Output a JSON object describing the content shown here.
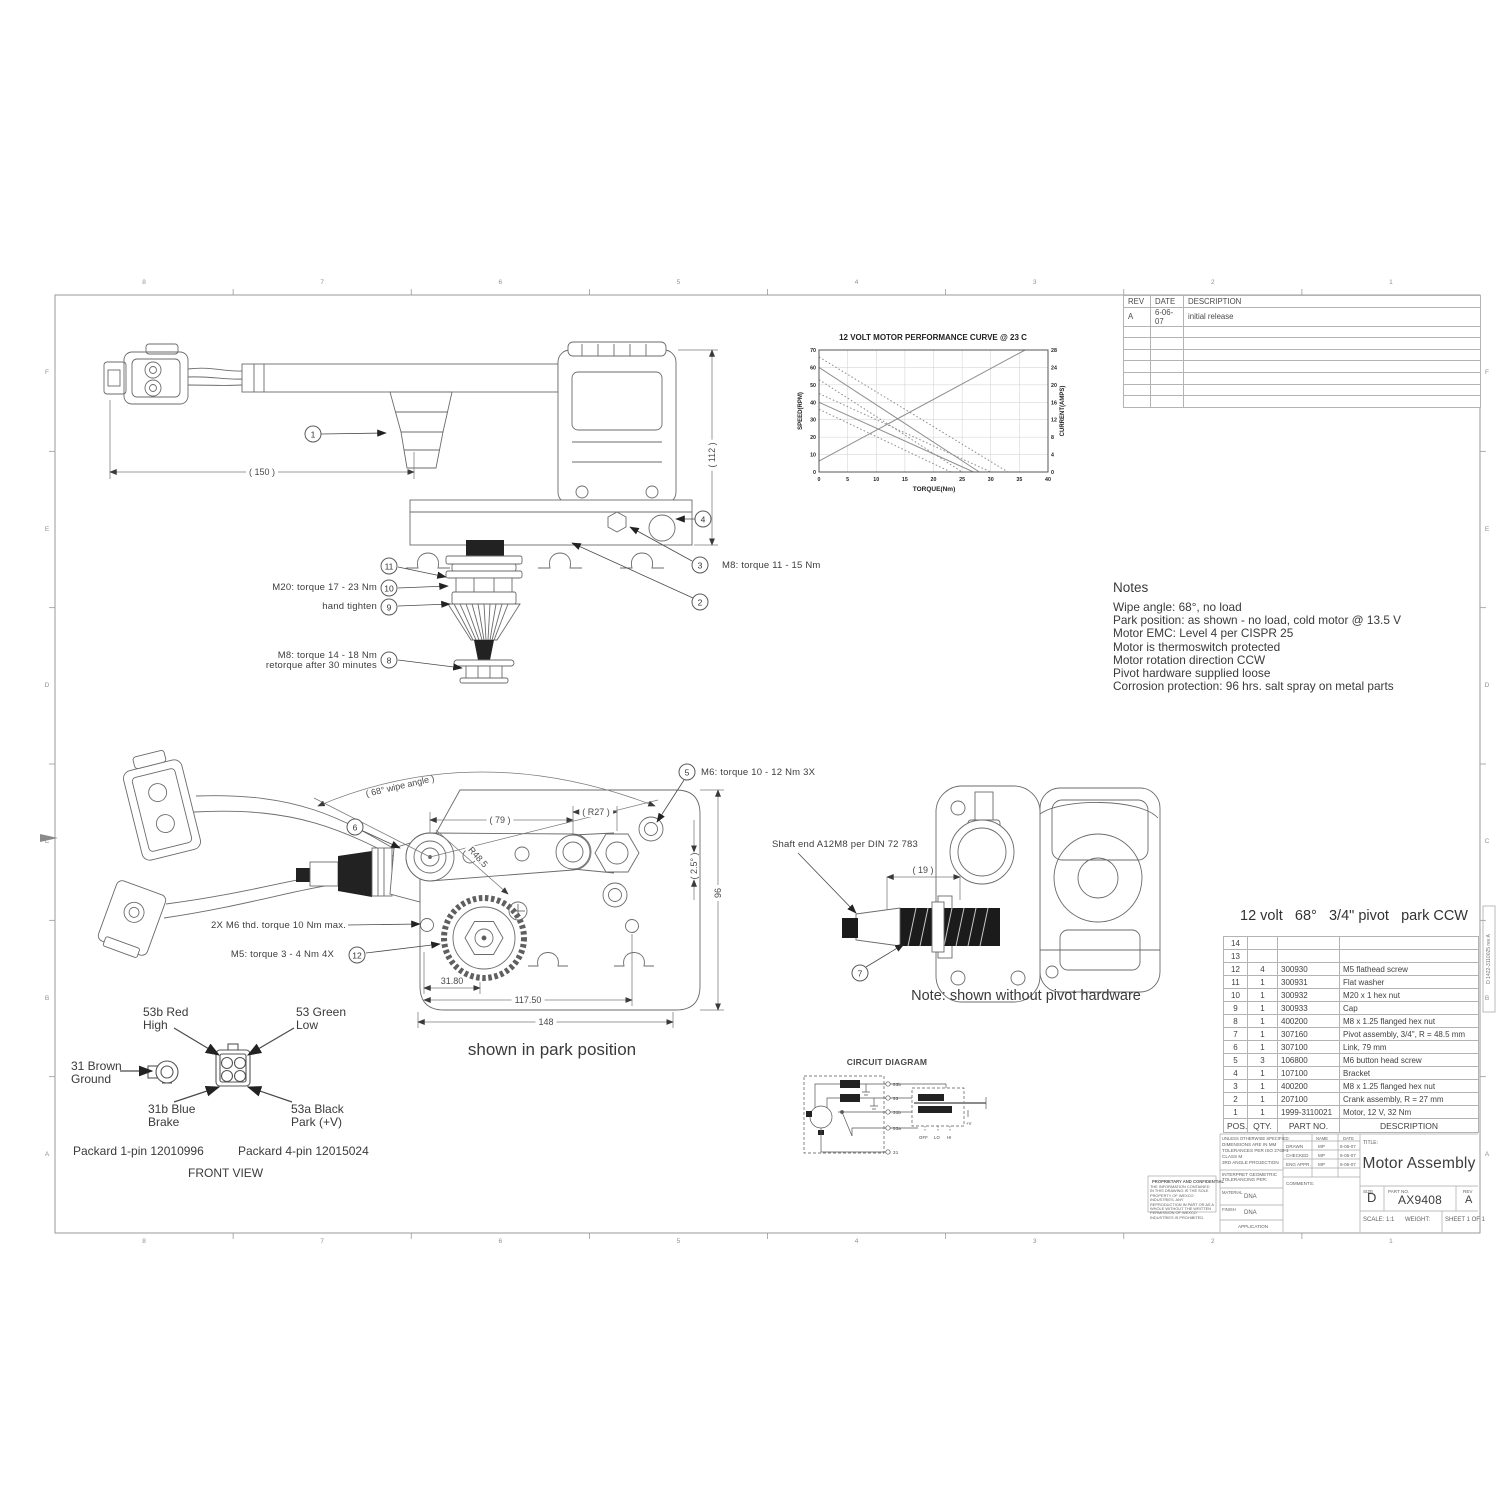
{
  "sheet": {
    "zones_cols": [
      "8",
      "7",
      "6",
      "5",
      "4",
      "3",
      "2",
      "1"
    ],
    "zones_rows": [
      "F",
      "E",
      "D",
      "C",
      "B",
      "A"
    ],
    "stamp_vertical": "D 1422-3110025 rev A"
  },
  "revision_table": {
    "headers": [
      "REV",
      "DATE",
      "DESCRIPTION"
    ],
    "rows": [
      [
        "A",
        "6-06-07",
        "initial release"
      ]
    ],
    "empty_rows": 7
  },
  "chart_data": {
    "type": "line",
    "title": "12 VOLT MOTOR PERFORMANCE CURVE @ 23 C",
    "xlabel": "TORQUE(Nm)",
    "ylabel_left": "SPEED(RPM)",
    "ylabel_right": "CURRENT(AMPS)",
    "xlim": [
      0,
      40
    ],
    "xtick_step": 5,
    "ylim_left": [
      0,
      70
    ],
    "ytick_step_left": 10,
    "ylim_right": [
      0,
      28
    ],
    "ytick_step_right": 4,
    "grid": true,
    "legend": "none",
    "series": [
      {
        "name": "speed nominal high",
        "axis": "left",
        "style": "solid",
        "points": [
          [
            0,
            60
          ],
          [
            28,
            0
          ]
        ]
      },
      {
        "name": "speed tolerance upper high",
        "axis": "left",
        "style": "dotted",
        "points": [
          [
            0,
            66
          ],
          [
            33,
            0
          ]
        ]
      },
      {
        "name": "speed tolerance lower high",
        "axis": "left",
        "style": "dotted",
        "points": [
          [
            0,
            53
          ],
          [
            25,
            0
          ]
        ]
      },
      {
        "name": "speed nominal low",
        "axis": "left",
        "style": "solid",
        "points": [
          [
            0,
            40
          ],
          [
            27,
            0
          ]
        ]
      },
      {
        "name": "speed tolerance upper low",
        "axis": "left",
        "style": "dotted",
        "points": [
          [
            0,
            45
          ],
          [
            30,
            0
          ]
        ]
      },
      {
        "name": "speed tolerance lower low",
        "axis": "left",
        "style": "dotted",
        "points": [
          [
            0,
            36
          ],
          [
            23,
            0
          ]
        ]
      },
      {
        "name": "current",
        "axis": "right",
        "style": "solid",
        "points": [
          [
            0,
            2.5
          ],
          [
            36,
            28
          ]
        ]
      }
    ]
  },
  "notes": {
    "title": "Notes",
    "lines": [
      "Wipe angle: 68°, no load",
      "Park position: as shown - no load, cold motor @ 13.5 V",
      "Motor EMC: Level 4 per CISPR 25",
      "Motor is thermoswitch protected",
      "Motor rotation direction CCW",
      "Pivot hardware supplied loose",
      "Corrosion protection: 96 hrs. salt spray on metal parts"
    ]
  },
  "balloons": {
    "b1": "1",
    "b2": "2",
    "b3": "3",
    "b4": "4",
    "b5": "5",
    "b6": "6",
    "b7": "7",
    "b8": "8",
    "b9": "9",
    "b10": "10",
    "b11": "11",
    "b12": "12"
  },
  "side_view": {
    "dim_150": "( 150 )",
    "dim_112": "( 112 )",
    "label_m20": "M20: torque 17 - 23 Nm",
    "label_hand": "hand tighten",
    "label_m8a_line1": "M8: torque 14 - 18 Nm",
    "label_m8a_line2": "retorque after 30 minutes",
    "label_m8b": "M8: torque 11 - 15 Nm"
  },
  "park_view": {
    "dim_wipe_angle": "( 68° wipe angle )",
    "dim_79": "( 79 )",
    "dim_r27": "( R27 )",
    "dim_r485": "R48.5",
    "dim_2_5": "( 2.5° )",
    "dim_96": "96",
    "dim_31_80": "31.80",
    "dim_117_50": "117.50",
    "dim_148": "148",
    "label_m6_3x": "M6: torque 10 - 12 Nm 3X",
    "label_2x_m6": "2X M6 thd. torque 10 Nm max.",
    "label_m5": "M5: torque 3 - 4 Nm 4X",
    "caption": "shown in park position"
  },
  "shaft_view": {
    "label_shaft_end": "Shaft end A12M8 per DIN 72 783",
    "dim_19": "( 19 )",
    "caption": "Note: shown without pivot hardware"
  },
  "connector_view": {
    "label_high_1": "53b Red",
    "label_high_2": "High",
    "label_low_1": "53 Green",
    "label_low_2": "Low",
    "label_ground_1": "31 Brown",
    "label_ground_2": "Ground",
    "label_brake_1": "31b Blue",
    "label_brake_2": "Brake",
    "label_park_1": "53a Black",
    "label_park_2": "Park (+V)",
    "packard_1pin": "Packard 1-pin 12010996",
    "packard_4pin": "Packard 4-pin 12015024",
    "caption": "FRONT VIEW"
  },
  "circuit": {
    "title": "CIRCUIT DIAGRAM",
    "t_53b": "53b",
    "t_53": "53",
    "t_31b": "31b",
    "t_53a": "53a",
    "t_31": "31",
    "sw_off": "OFF",
    "sw_lo": "LO",
    "sw_hi": "HI",
    "plus_v": "+V"
  },
  "parts_list": {
    "spec": {
      "volt": "12 volt",
      "angle": "68°",
      "pivot": "3/4\" pivot",
      "park": "park CCW"
    },
    "columns": [
      "POS.",
      "QTY.",
      "PART NO.",
      "DESCRIPTION"
    ],
    "rows": [
      [
        "14",
        "",
        "",
        ""
      ],
      [
        "13",
        "",
        "",
        ""
      ],
      [
        "12",
        "4",
        "300930",
        "M5 flathead screw"
      ],
      [
        "11",
        "1",
        "300931",
        "Flat washer"
      ],
      [
        "10",
        "1",
        "300932",
        "M20 x 1 hex nut"
      ],
      [
        "9",
        "1",
        "300933",
        "Cap"
      ],
      [
        "8",
        "1",
        "400200",
        "M8 x 1.25 flanged hex nut"
      ],
      [
        "7",
        "1",
        "307160",
        "Pivot assembly, 3/4\", R = 48.5 mm"
      ],
      [
        "6",
        "1",
        "307100",
        "Link, 79 mm"
      ],
      [
        "5",
        "3",
        "106800",
        "M6 button head screw"
      ],
      [
        "4",
        "1",
        "107100",
        "Bracket"
      ],
      [
        "3",
        "1",
        "400200",
        "M8 x 1.25 flanged hex nut"
      ],
      [
        "2",
        "1",
        "207100",
        "Crank assembly, R = 27 mm"
      ],
      [
        "1",
        "1",
        "1999-3110021",
        "Motor, 12 V, 32 Nm"
      ]
    ]
  },
  "title_block": {
    "proprietary_title": "PROPRIETARY AND CONFIDENTIAL",
    "proprietary_body": "THE INFORMATION CONTAINED IN THIS DRAWING IS THE SOLE PROPERTY OF WEXCO INDUSTRIES. ANY REPRODUCTION IN PART OR AS A WHOLE WITHOUT THE WRITTEN PERMISSION OF WEXCO INDUSTRIES IS PROHIBITED.",
    "unless": "UNLESS OTHERWISE SPECIFIED:",
    "spec_line_1": "DIMENSIONS ARE IN MM",
    "spec_line_2": "TOLERANCES PER ISO 2768-1",
    "spec_line_3": "CLASS M",
    "spec_line_4": "3RD ANGLE PROJECTION",
    "interpret": "INTERPRET GEOMETRIC TOLERANCING PER:",
    "material_label": "MATERIAL",
    "material_value": "DNA",
    "finish_label": "FINISH",
    "finish_value": "DNA",
    "application_label": "APPLICATION",
    "name_label": "NAME",
    "date_label": "DATE",
    "drawn_label": "DRAWN",
    "drawn_name": "MP",
    "drawn_date": "6-06-07",
    "checked_label": "CHECKED",
    "checked_name": "MP",
    "checked_date": "6-06-07",
    "engappr_label": "ENG APPR.",
    "engappr_name": "MP",
    "engappr_date": "6-06-07",
    "comments_label": "COMMENTS:",
    "title_label": "TITLE:",
    "title": "Motor Assembly",
    "size_label": "SIZE",
    "size": "D",
    "partno_label": "PART NO.",
    "partno": "AX9408",
    "rev_label": "REV",
    "rev": "A",
    "scale_label": "SCALE: 1:1",
    "weight_label": "WEIGHT:",
    "sheet_label": "SHEET 1 OF 1"
  }
}
